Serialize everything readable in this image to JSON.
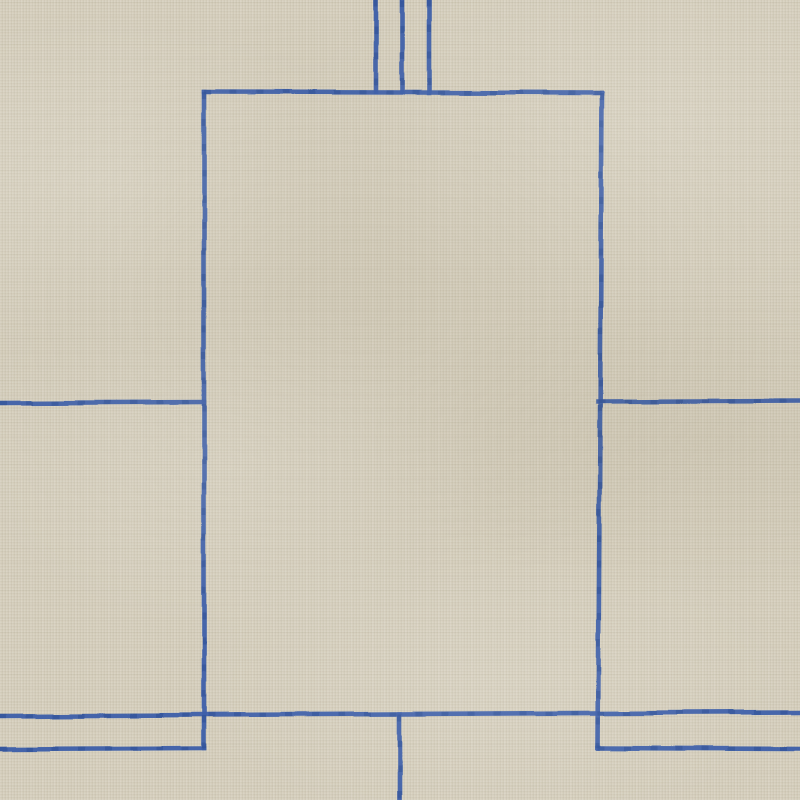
{
  "scene": {
    "type": "photograph",
    "subject": "Hand-woven rug with minimalist blue geometric line pattern on bone-beige fabric",
    "background_color": "#d6cfbd",
    "line_color": "#3b5ea9",
    "line_dark_color": "#2b4c92",
    "line_width": 4.6
  },
  "canvas": {
    "width": 800,
    "height": 800
  },
  "segments": [
    {
      "name": "top-stripe-left",
      "x1": 376,
      "y1": 0,
      "x2": 376,
      "y2": 92
    },
    {
      "name": "top-stripe-middle",
      "x1": 402,
      "y1": 0,
      "x2": 402,
      "y2": 92
    },
    {
      "name": "top-stripe-right",
      "x1": 429,
      "y1": 0,
      "x2": 429,
      "y2": 93
    },
    {
      "name": "panel-top-edge",
      "x1": 204,
      "y1": 92,
      "x2": 602,
      "y2": 93
    },
    {
      "name": "panel-left-edge",
      "x1": 204,
      "y1": 92,
      "x2": 204,
      "y2": 748
    },
    {
      "name": "panel-right-edge",
      "x1": 602,
      "y1": 93,
      "x2": 598,
      "y2": 748
    },
    {
      "name": "mid-left-horizontal",
      "x1": 0,
      "y1": 403,
      "x2": 204,
      "y2": 402
    },
    {
      "name": "mid-right-horizontal",
      "x1": 598,
      "y1": 402,
      "x2": 800,
      "y2": 401
    },
    {
      "name": "lower-full-horizontal",
      "x1": 0,
      "y1": 716,
      "x2": 800,
      "y2": 712
    },
    {
      "name": "bottom-left-horizontal",
      "x1": 0,
      "y1": 749,
      "x2": 204,
      "y2": 748
    },
    {
      "name": "bottom-right-horizontal",
      "x1": 598,
      "y1": 748,
      "x2": 800,
      "y2": 749
    },
    {
      "name": "bottom-center-vertical",
      "x1": 400,
      "y1": 714,
      "x2": 400,
      "y2": 801
    }
  ]
}
